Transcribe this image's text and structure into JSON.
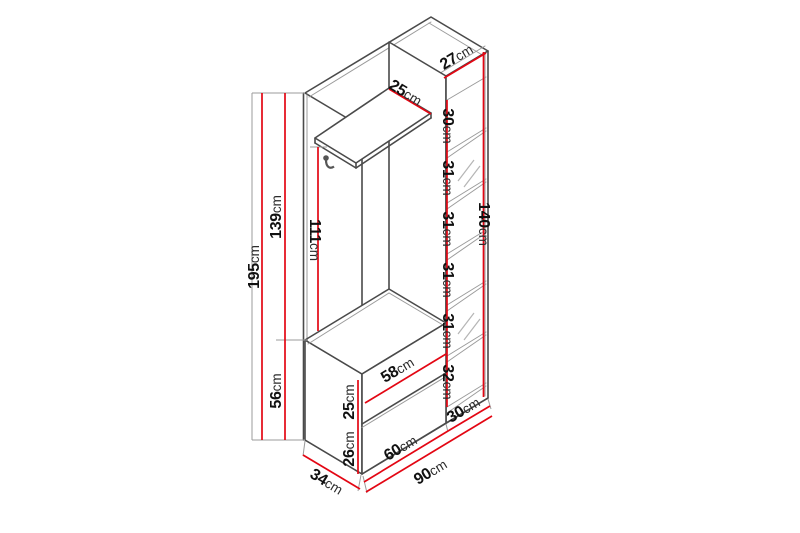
{
  "diagram_title": "hallway-unit-dimension-diagram",
  "colors": {
    "dimension_line": "#e30613",
    "outline": "#4a4a4a",
    "background": "#ffffff"
  },
  "labels": [
    {
      "id": "total-height",
      "num": "195",
      "unit": "cm"
    },
    {
      "id": "upper-section-height",
      "num": "139",
      "unit": "cm"
    },
    {
      "id": "lower-section-height",
      "num": "56",
      "unit": "cm"
    },
    {
      "id": "hanging-height",
      "num": "111",
      "unit": "cm"
    },
    {
      "id": "shelf-depth",
      "num": "25",
      "unit": "cm"
    },
    {
      "id": "top-depth",
      "num": "27",
      "unit": "cm"
    },
    {
      "id": "compartment-1",
      "num": "30",
      "unit": "cm"
    },
    {
      "id": "compartment-2",
      "num": "31",
      "unit": "cm"
    },
    {
      "id": "compartment-3",
      "num": "31",
      "unit": "cm"
    },
    {
      "id": "compartment-4",
      "num": "31",
      "unit": "cm"
    },
    {
      "id": "compartment-5",
      "num": "31",
      "unit": "cm"
    },
    {
      "id": "compartment-6",
      "num": "32",
      "unit": "cm"
    },
    {
      "id": "column-height",
      "num": "140",
      "unit": "cm"
    },
    {
      "id": "bench-upper-height",
      "num": "25",
      "unit": "cm"
    },
    {
      "id": "bench-lower-height",
      "num": "26",
      "unit": "cm"
    },
    {
      "id": "bench-inner-width",
      "num": "58",
      "unit": "cm"
    },
    {
      "id": "depth",
      "num": "34",
      "unit": "cm"
    },
    {
      "id": "left-section-width",
      "num": "60",
      "unit": "cm"
    },
    {
      "id": "right-section-width",
      "num": "30",
      "unit": "cm"
    },
    {
      "id": "total-width",
      "num": "90",
      "unit": "cm"
    }
  ]
}
